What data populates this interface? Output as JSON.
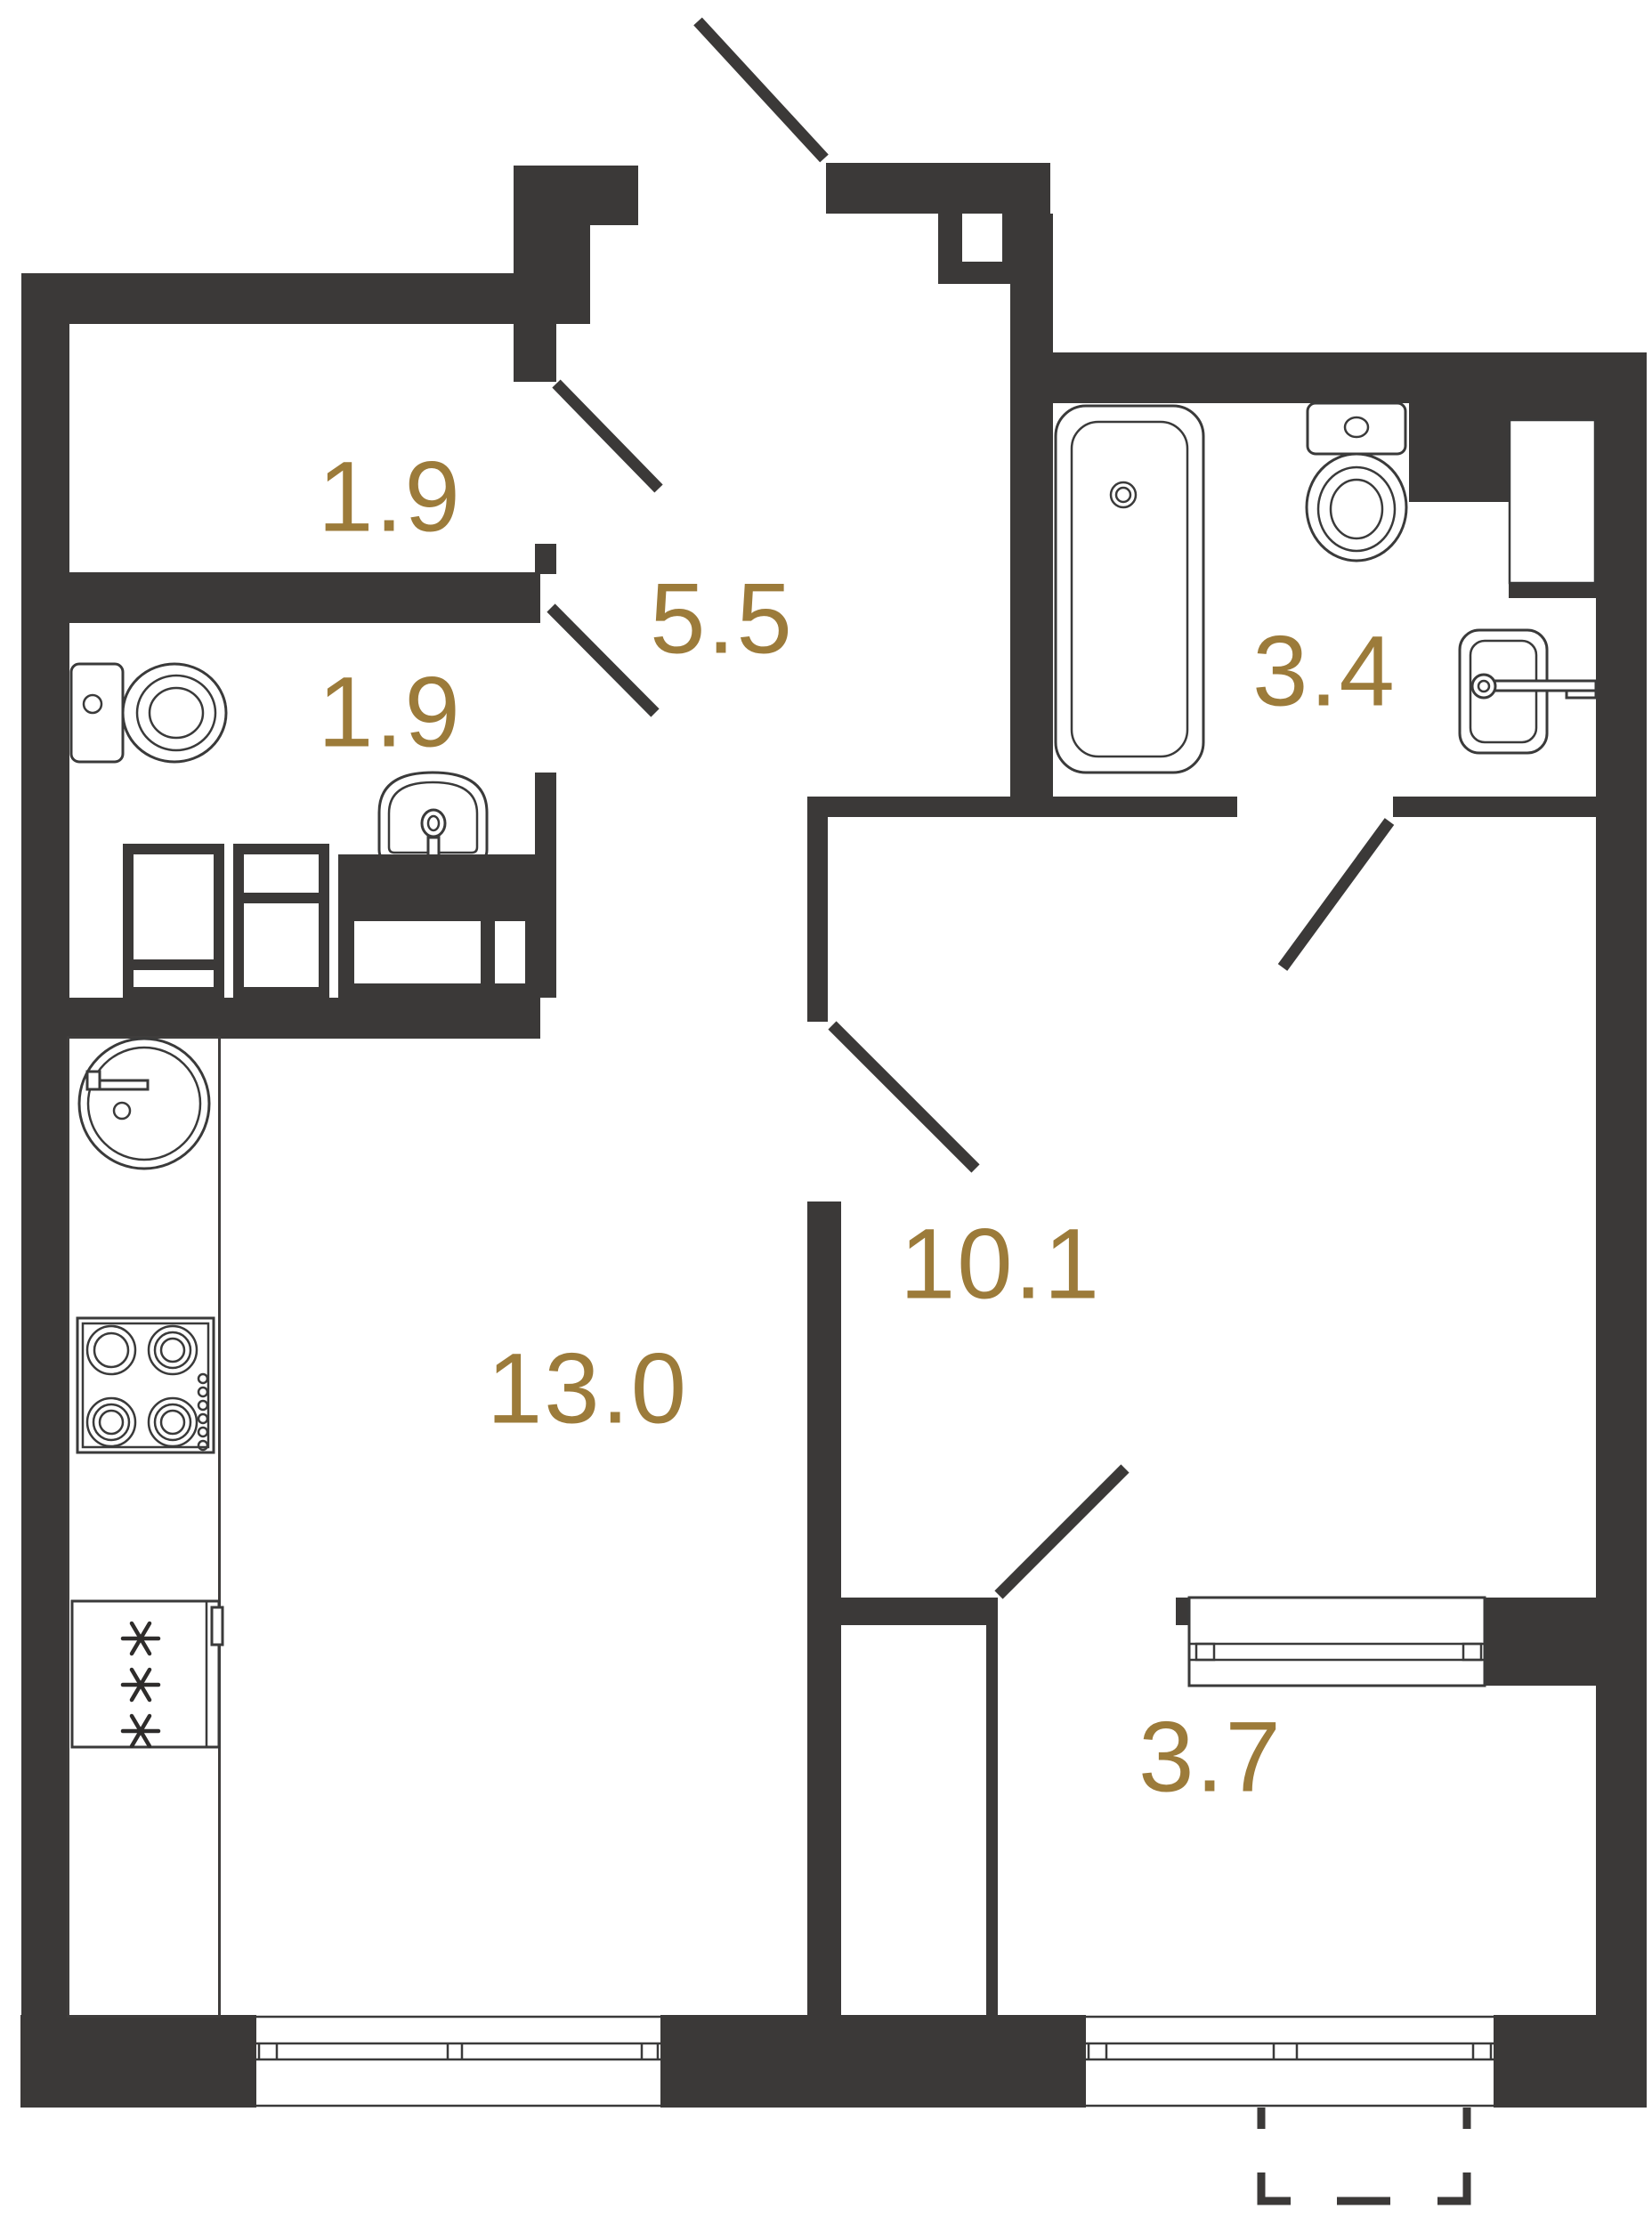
{
  "plan": {
    "wall_color": "#3b3938",
    "label_color": "#9c7b3a",
    "rooms": [
      {
        "name": "storage-top",
        "area": "1.9"
      },
      {
        "name": "hallway",
        "area": "5.5"
      },
      {
        "name": "wc",
        "area": "1.9"
      },
      {
        "name": "bathroom",
        "area": "3.4"
      },
      {
        "name": "kitchen-living-room",
        "area": "13.0"
      },
      {
        "name": "hall",
        "area": "10.1"
      },
      {
        "name": "wardrobe-room",
        "area": "3.7"
      }
    ],
    "fixtures": [
      "bathtub",
      "toilet",
      "washbasin",
      "kitchen-sink",
      "stove",
      "fridge-freezer",
      "wardrobe",
      "window",
      "balcony-outline"
    ]
  }
}
